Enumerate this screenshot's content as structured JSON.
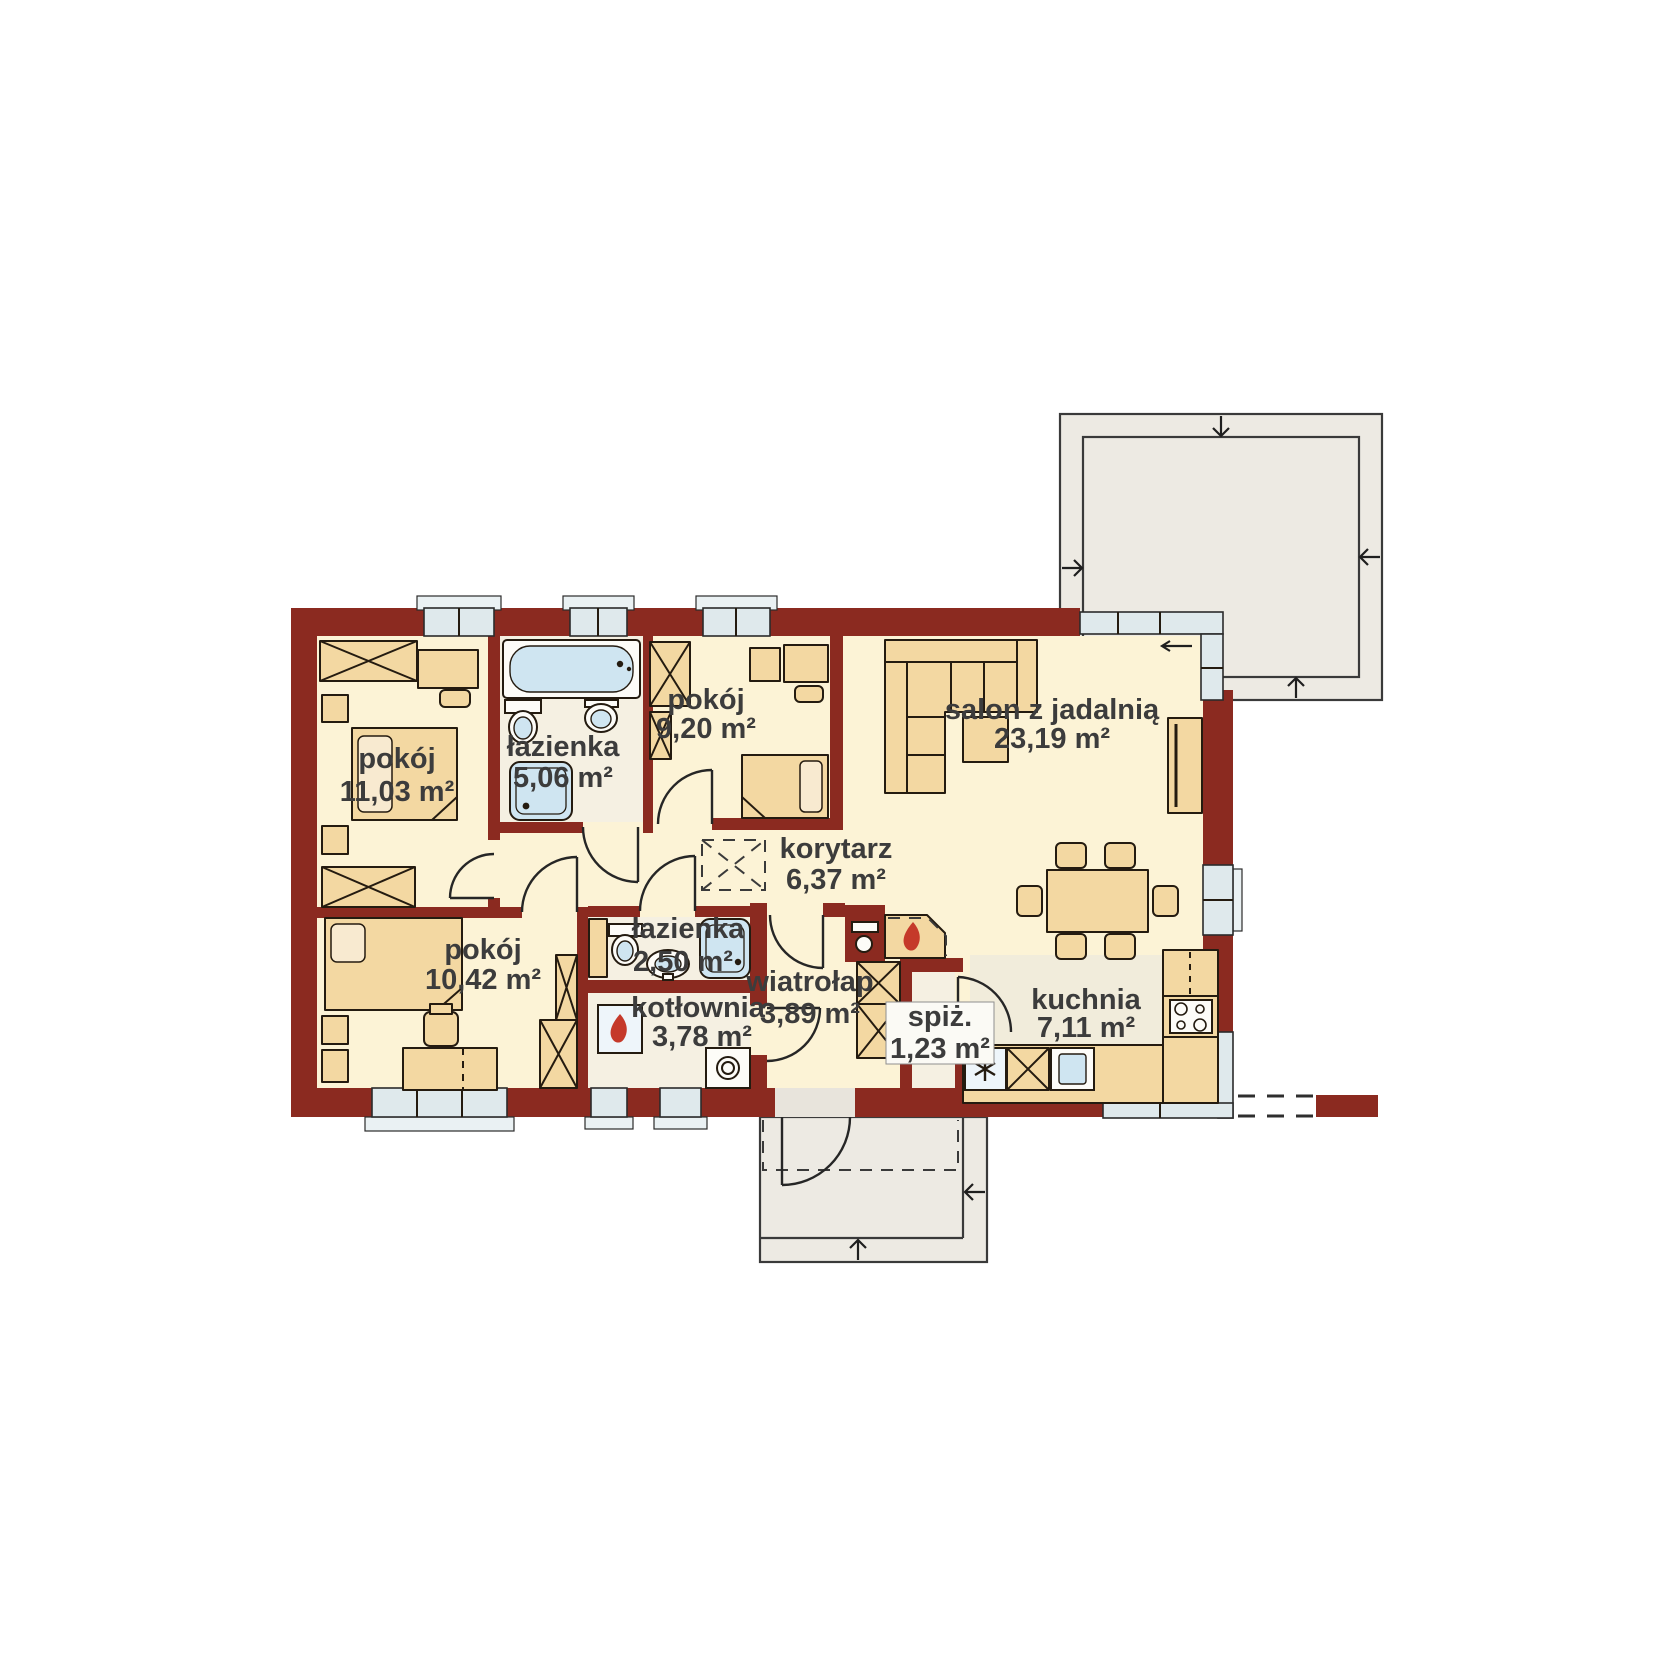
{
  "rooms": [
    {
      "name": "pokój",
      "area": "11,03 m²"
    },
    {
      "name": "łazienka",
      "area": "5,06 m²"
    },
    {
      "name": "pokój",
      "area": "9,20 m²"
    },
    {
      "name": "salon z jadalnią",
      "area": "23,19 m²"
    },
    {
      "name": "korytarz",
      "area": "6,37 m²"
    },
    {
      "name": "pokój",
      "area": "10,42 m²"
    },
    {
      "name": "łazienka",
      "area": "2,50 m²"
    },
    {
      "name": "kotłownia",
      "area": "3,78 m²"
    },
    {
      "name": "wiatrołap",
      "area": "3,89 m²"
    },
    {
      "name": "spiż.",
      "area": "1,23 m²"
    },
    {
      "name": "kuchnia",
      "area": "7,11 m²"
    }
  ],
  "colors": {
    "wall": "#8b2a20",
    "floor": "#fcf3d6",
    "floorService": "#f5f0e2",
    "floorKitchen": "#f1ecdb",
    "furniture": "#f3d8a2",
    "fixture": "#cfe5f1",
    "glass": "#dfe9ec",
    "terrace": "#edeae3",
    "flame": "#c5392a",
    "text": "#3c3c3c"
  }
}
